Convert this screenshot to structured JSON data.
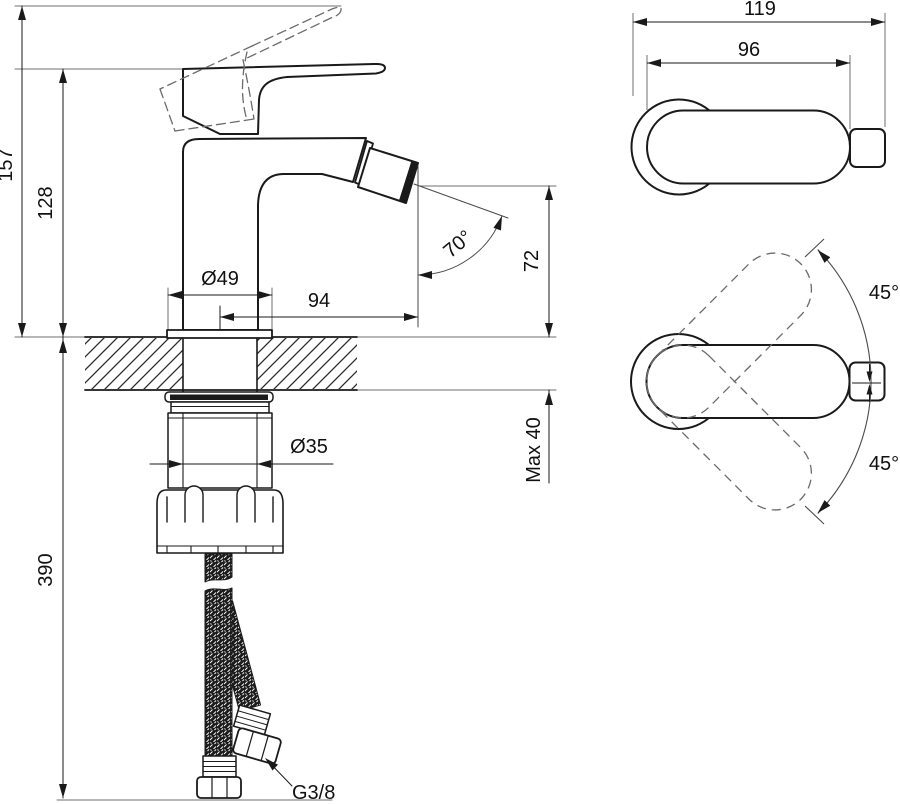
{
  "document": {
    "type": "technical-drawing",
    "subject": "Single-lever bidet mixer tap — installation dimensions",
    "background_color": "#ffffff",
    "line_color": "#1a1a1a",
    "dashed_line_color": "#6b6b6b"
  },
  "side_view": {
    "dims": {
      "total_height": "157",
      "body_height": "128",
      "hose_drop": "390",
      "base_diameter": "Ø49",
      "spout_reach": "94",
      "spout_angle": "70°",
      "outlet_height": "72",
      "deck_thickness": "Max 40",
      "shank_diameter": "Ø35",
      "hose_thread": "G3/8"
    }
  },
  "top_view": {
    "dims": {
      "total_length": "119",
      "body_length": "96"
    }
  },
  "swivel_view": {
    "dims": {
      "swivel_up": "45°",
      "swivel_down": "45°"
    }
  }
}
